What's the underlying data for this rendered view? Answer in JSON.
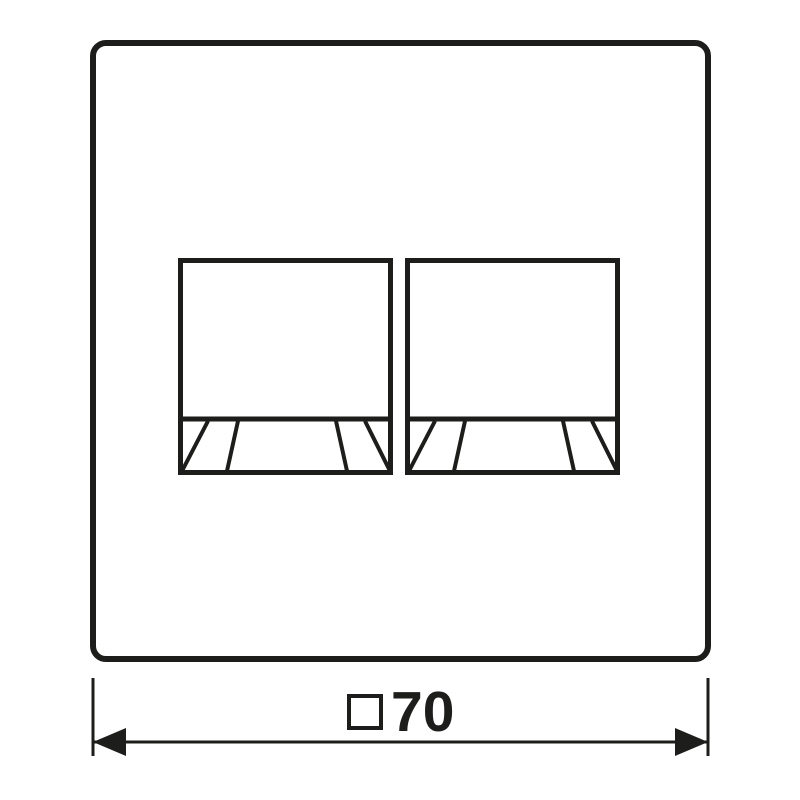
{
  "drawing": {
    "kind": "technical-dimension-drawing",
    "dimension": {
      "symbol": "square-symbol",
      "value": "70"
    }
  },
  "colors": {
    "ink": "#1d1d1b",
    "background": "#ffffff"
  }
}
